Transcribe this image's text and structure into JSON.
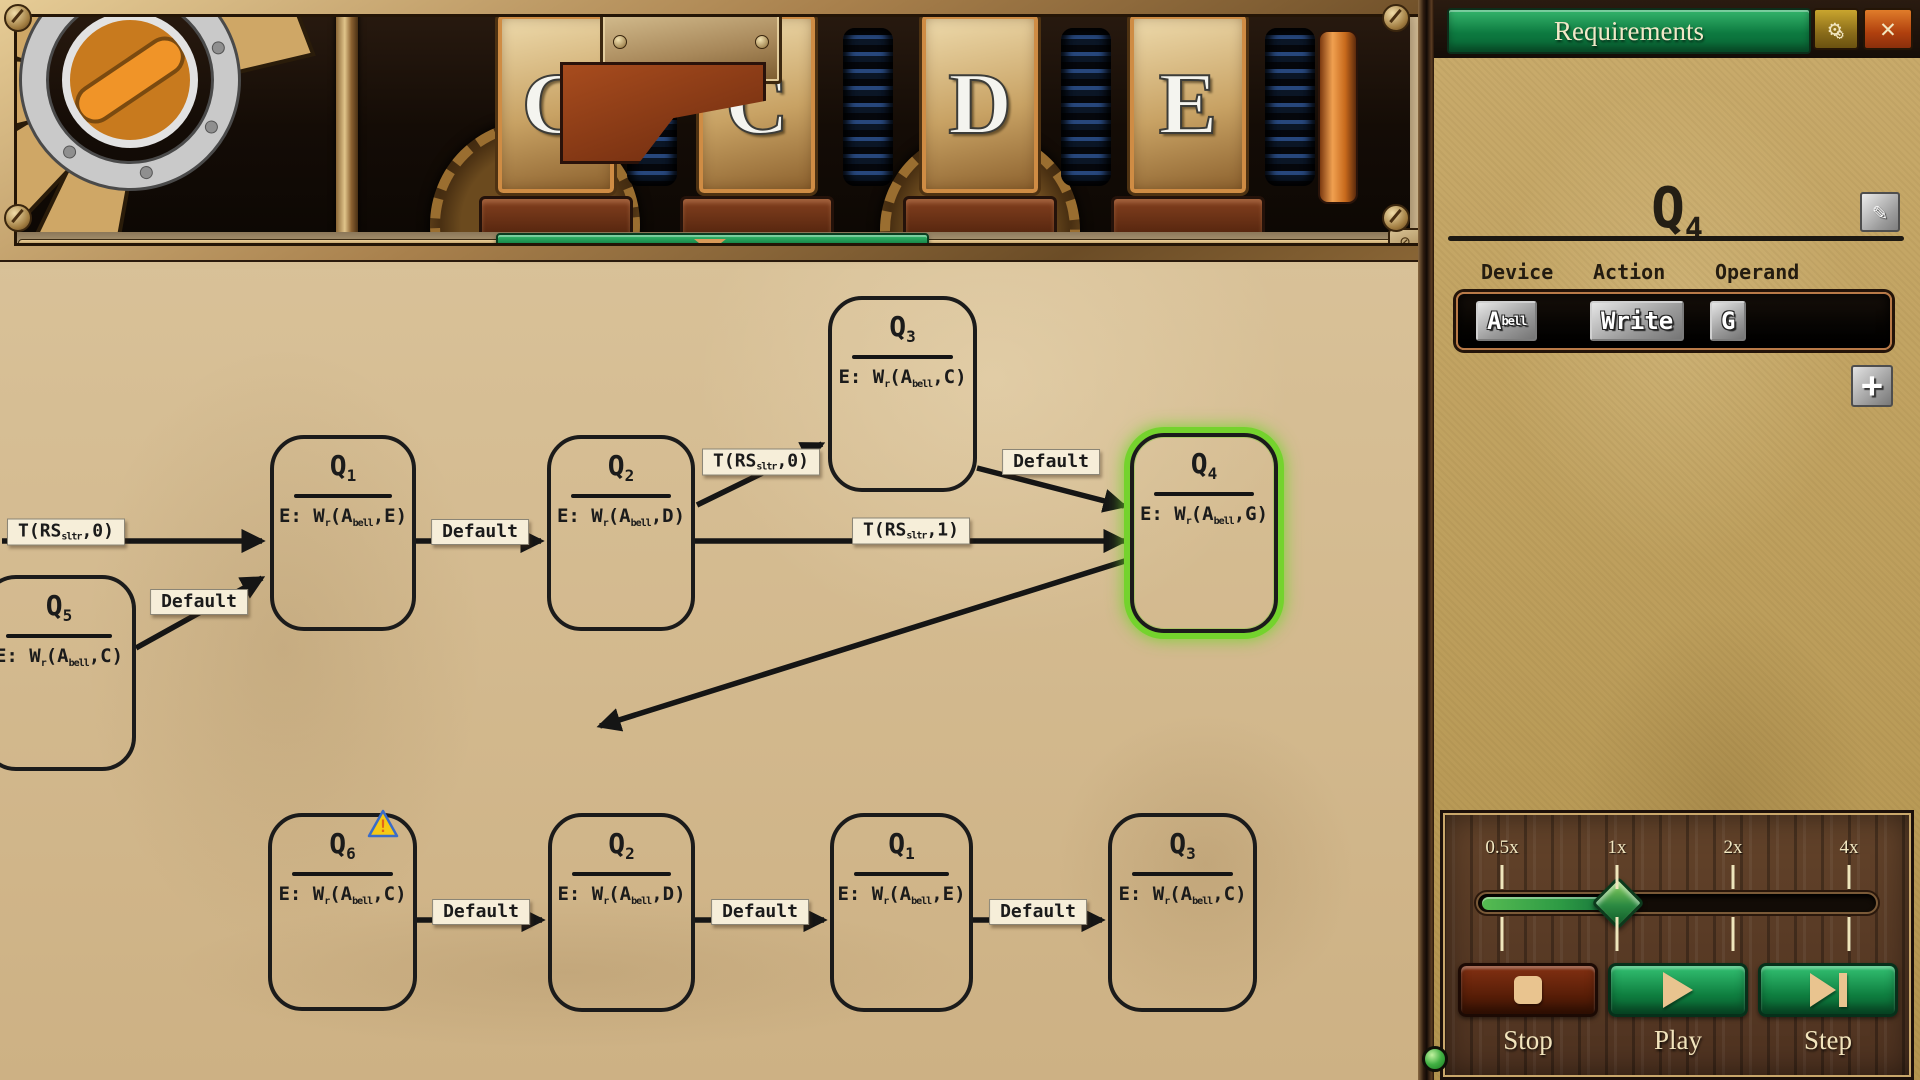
{
  "icons": {
    "gear": "⚙",
    "gear_small": "⚙",
    "close": "✕",
    "pencil": "✎",
    "plus": "+",
    "warning": "!"
  },
  "colors": {
    "accent_green": "#0d7a40",
    "glow_green": "#74d32d",
    "parchment": "#d6bd92",
    "panel_parchment": "#c1a263",
    "wood": "#5a3c24",
    "stop_red": "#561d07",
    "icon_tan": "#e9c48f"
  },
  "top_banner": {
    "letters": [
      "G",
      "C",
      "D",
      "E"
    ],
    "letter_xs": [
      556,
      757,
      980,
      1188
    ],
    "coil_xs": [
      652,
      868,
      1086,
      1290
    ]
  },
  "diagram": {
    "body_template": {
      "prefix": "E: W",
      "w_sub": "r",
      "mid": "(A",
      "a_sub": "bell",
      "comma": ",",
      "close": ")"
    },
    "title_letter": "Q",
    "nodes": [
      {
        "id": "q1",
        "sub": "1",
        "note": "E",
        "x": 270,
        "y": 435,
        "w": 146,
        "h": 196,
        "active": false,
        "warning": false
      },
      {
        "id": "q2",
        "sub": "2",
        "note": "D",
        "x": 547,
        "y": 435,
        "w": 148,
        "h": 196,
        "active": false,
        "warning": false
      },
      {
        "id": "q3",
        "sub": "3",
        "note": "C",
        "x": 828,
        "y": 296,
        "w": 149,
        "h": 196,
        "active": false,
        "warning": false
      },
      {
        "id": "q4",
        "sub": "4",
        "note": "G",
        "x": 1130,
        "y": 433,
        "w": 148,
        "h": 200,
        "active": true,
        "warning": false
      },
      {
        "id": "q5",
        "sub": "5",
        "note": "C",
        "x": -18,
        "y": 575,
        "w": 154,
        "h": 196,
        "active": false,
        "warning": false
      },
      {
        "id": "q6",
        "sub": "6",
        "note": "C",
        "x": 268,
        "y": 813,
        "w": 149,
        "h": 198,
        "active": false,
        "warning": true
      },
      {
        "id": "q2b",
        "sub": "2",
        "note": "D",
        "x": 548,
        "y": 813,
        "w": 147,
        "h": 199,
        "active": false,
        "warning": false
      },
      {
        "id": "q1b",
        "sub": "1",
        "note": "E",
        "x": 830,
        "y": 813,
        "w": 143,
        "h": 199,
        "active": false,
        "warning": false
      },
      {
        "id": "q3b",
        "sub": "3",
        "note": "C",
        "x": 1108,
        "y": 813,
        "w": 149,
        "h": 199,
        "active": false,
        "warning": false
      }
    ],
    "edges": [
      {
        "x1": 2,
        "y1": 541,
        "x2": 262,
        "y2": 541
      },
      {
        "x1": 136,
        "y1": 648,
        "x2": 262,
        "y2": 578
      },
      {
        "x1": 416,
        "y1": 541,
        "x2": 541,
        "y2": 541
      },
      {
        "x1": 697,
        "y1": 505,
        "x2": 822,
        "y2": 444
      },
      {
        "x1": 695,
        "y1": 541,
        "x2": 1124,
        "y2": 541
      },
      {
        "x1": 977,
        "y1": 468,
        "x2": 1124,
        "y2": 506
      },
      {
        "x1": 1128,
        "y1": 560,
        "x2": 600,
        "y2": 726
      },
      {
        "x1": 417,
        "y1": 920,
        "x2": 542,
        "y2": 920
      },
      {
        "x1": 695,
        "y1": 920,
        "x2": 824,
        "y2": 920
      },
      {
        "x1": 973,
        "y1": 920,
        "x2": 1102,
        "y2": 920
      }
    ],
    "labels": [
      {
        "pre": "T(RS",
        "sub": "sltr",
        "post": ",0)",
        "cx": 66,
        "cy": 532
      },
      {
        "pre": "Default",
        "cx": 199,
        "cy": 602
      },
      {
        "pre": "Default",
        "cx": 480,
        "cy": 532
      },
      {
        "pre": "T(RS",
        "sub": "sltr",
        "post": ",0)",
        "cx": 761,
        "cy": 462
      },
      {
        "pre": "T(RS",
        "sub": "sltr",
        "post": ",1)",
        "cx": 911,
        "cy": 531
      },
      {
        "pre": "Default",
        "cx": 1051,
        "cy": 462
      },
      {
        "pre": "Default",
        "cx": 481,
        "cy": 912
      },
      {
        "pre": "Default",
        "cx": 760,
        "cy": 912
      },
      {
        "pre": "Default",
        "cx": 1038,
        "cy": 912
      }
    ]
  },
  "panel": {
    "title": "Requirements",
    "state_q": "Q",
    "state_sub": "4",
    "columns": [
      {
        "label": "Device",
        "x": 47
      },
      {
        "label": "Action",
        "x": 159
      },
      {
        "label": "Operand",
        "x": 281
      }
    ],
    "chips": [
      {
        "pre": "A",
        "sub": "bell",
        "x": 18
      },
      {
        "pre": "Write",
        "x": 132
      },
      {
        "pre": "G",
        "x": 252
      }
    ],
    "add_label": "+",
    "speed": {
      "marks": [
        {
          "label": "0.5x",
          "x": 59
        },
        {
          "label": "1x",
          "x": 174
        },
        {
          "label": "2x",
          "x": 290
        },
        {
          "label": "4x",
          "x": 406
        }
      ],
      "current": "1x"
    },
    "transport": [
      {
        "id": "stop",
        "label": "Stop",
        "x": 15,
        "style": "red",
        "icon": "stop-icon"
      },
      {
        "id": "play",
        "label": "Play",
        "x": 165,
        "style": "green",
        "icon": "play-icon"
      },
      {
        "id": "step",
        "label": "Step",
        "x": 315,
        "style": "green",
        "icon": "step-icon"
      }
    ]
  }
}
